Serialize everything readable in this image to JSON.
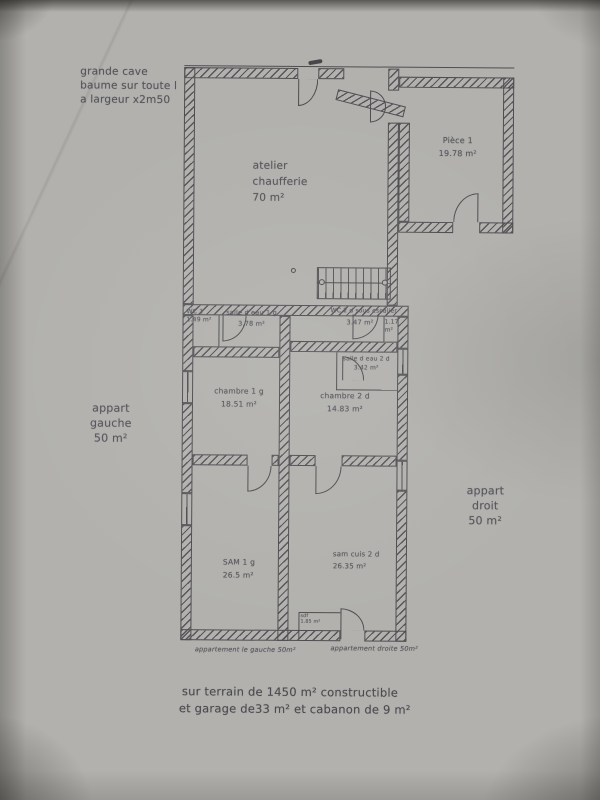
{
  "colors": {
    "paper": "#b2b1ad",
    "ink": "#4e4e52"
  },
  "labels": {
    "grande_cave": "grande cave\nbaume sur toute l\na largeur x2m50",
    "appart_gauche": "appart\ngauche\n50 m²",
    "appart_droit": "appart\ndroit\n50 m²",
    "caption_left": "appartement le gauche 50m²",
    "caption_right": "appartement droite 50m²",
    "footer1": "sur terrain de 1450 m² constructible",
    "footer2": "et garage de33 m² et cabanon de 9 m²"
  },
  "rooms": {
    "atelier": "atelier\nchaufferie\n70 m²",
    "piece1": "Pièce 1\n19.78 m²",
    "wc1": "WC 1\n1.49 m²",
    "sde1": "salle d eau 1 g\n3.78 m²",
    "wc2_title": "WC 2 d sous escalier",
    "wc2_area": "3.47 m²",
    "wc2_closet": "1.17 m²",
    "sde2": "salle d eau 2 d\n3.42 m²",
    "chambre1": "chambre 1 g\n18.51 m²",
    "chambre2": "chambre 2 d\n14.83 m²",
    "sam1": "SAM 1 g\n26.5 m²",
    "samcuis2": "sam cuis 2 d\n26.35 m²",
    "sdf": "sdf\n1.85 m²"
  }
}
